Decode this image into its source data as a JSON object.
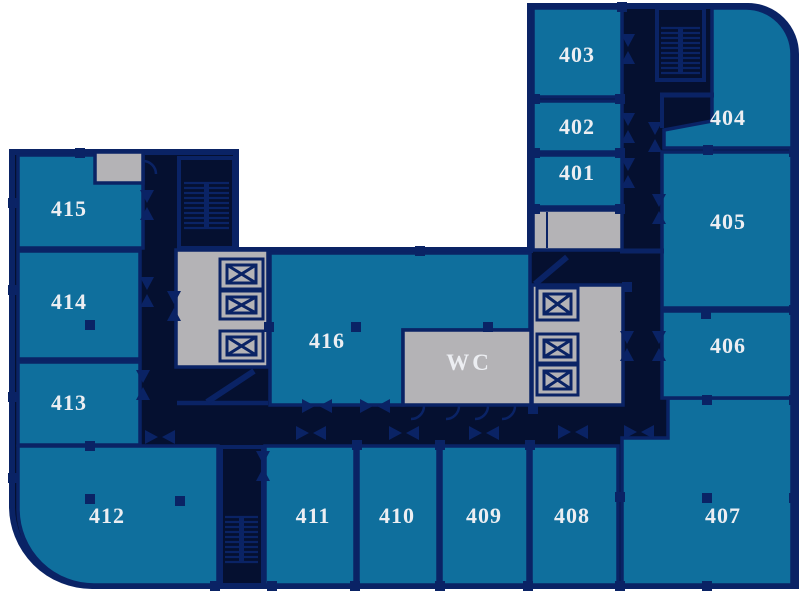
{
  "plan": {
    "type": "office-floor-plan",
    "floor_prefix": "4"
  },
  "rooms": {
    "r401": {
      "label": "401"
    },
    "r402": {
      "label": "402"
    },
    "r403": {
      "label": "403"
    },
    "r404": {
      "label": "404"
    },
    "r405": {
      "label": "405"
    },
    "r406": {
      "label": "406"
    },
    "r407": {
      "label": "407"
    },
    "r408": {
      "label": "408"
    },
    "r409": {
      "label": "409"
    },
    "r410": {
      "label": "410"
    },
    "r411": {
      "label": "411"
    },
    "r412": {
      "label": "412"
    },
    "r413": {
      "label": "413"
    },
    "r414": {
      "label": "414"
    },
    "r415": {
      "label": "415"
    },
    "r416": {
      "label": "416"
    },
    "wc": {
      "label": "WC"
    }
  },
  "icons": {
    "elevator": "elevator-icon",
    "stairs": "stairs-icon",
    "door": "door-swing-icon",
    "wc_door": "door-arc-icon",
    "column": "structural-column"
  },
  "colors": {
    "room_fill": "#0f6f9d",
    "wall_navy": "#0a2365",
    "void_dark": "#051030",
    "service_gray": "#b4b3b6",
    "label_text": "#eceef2",
    "background": "#ffffff"
  }
}
